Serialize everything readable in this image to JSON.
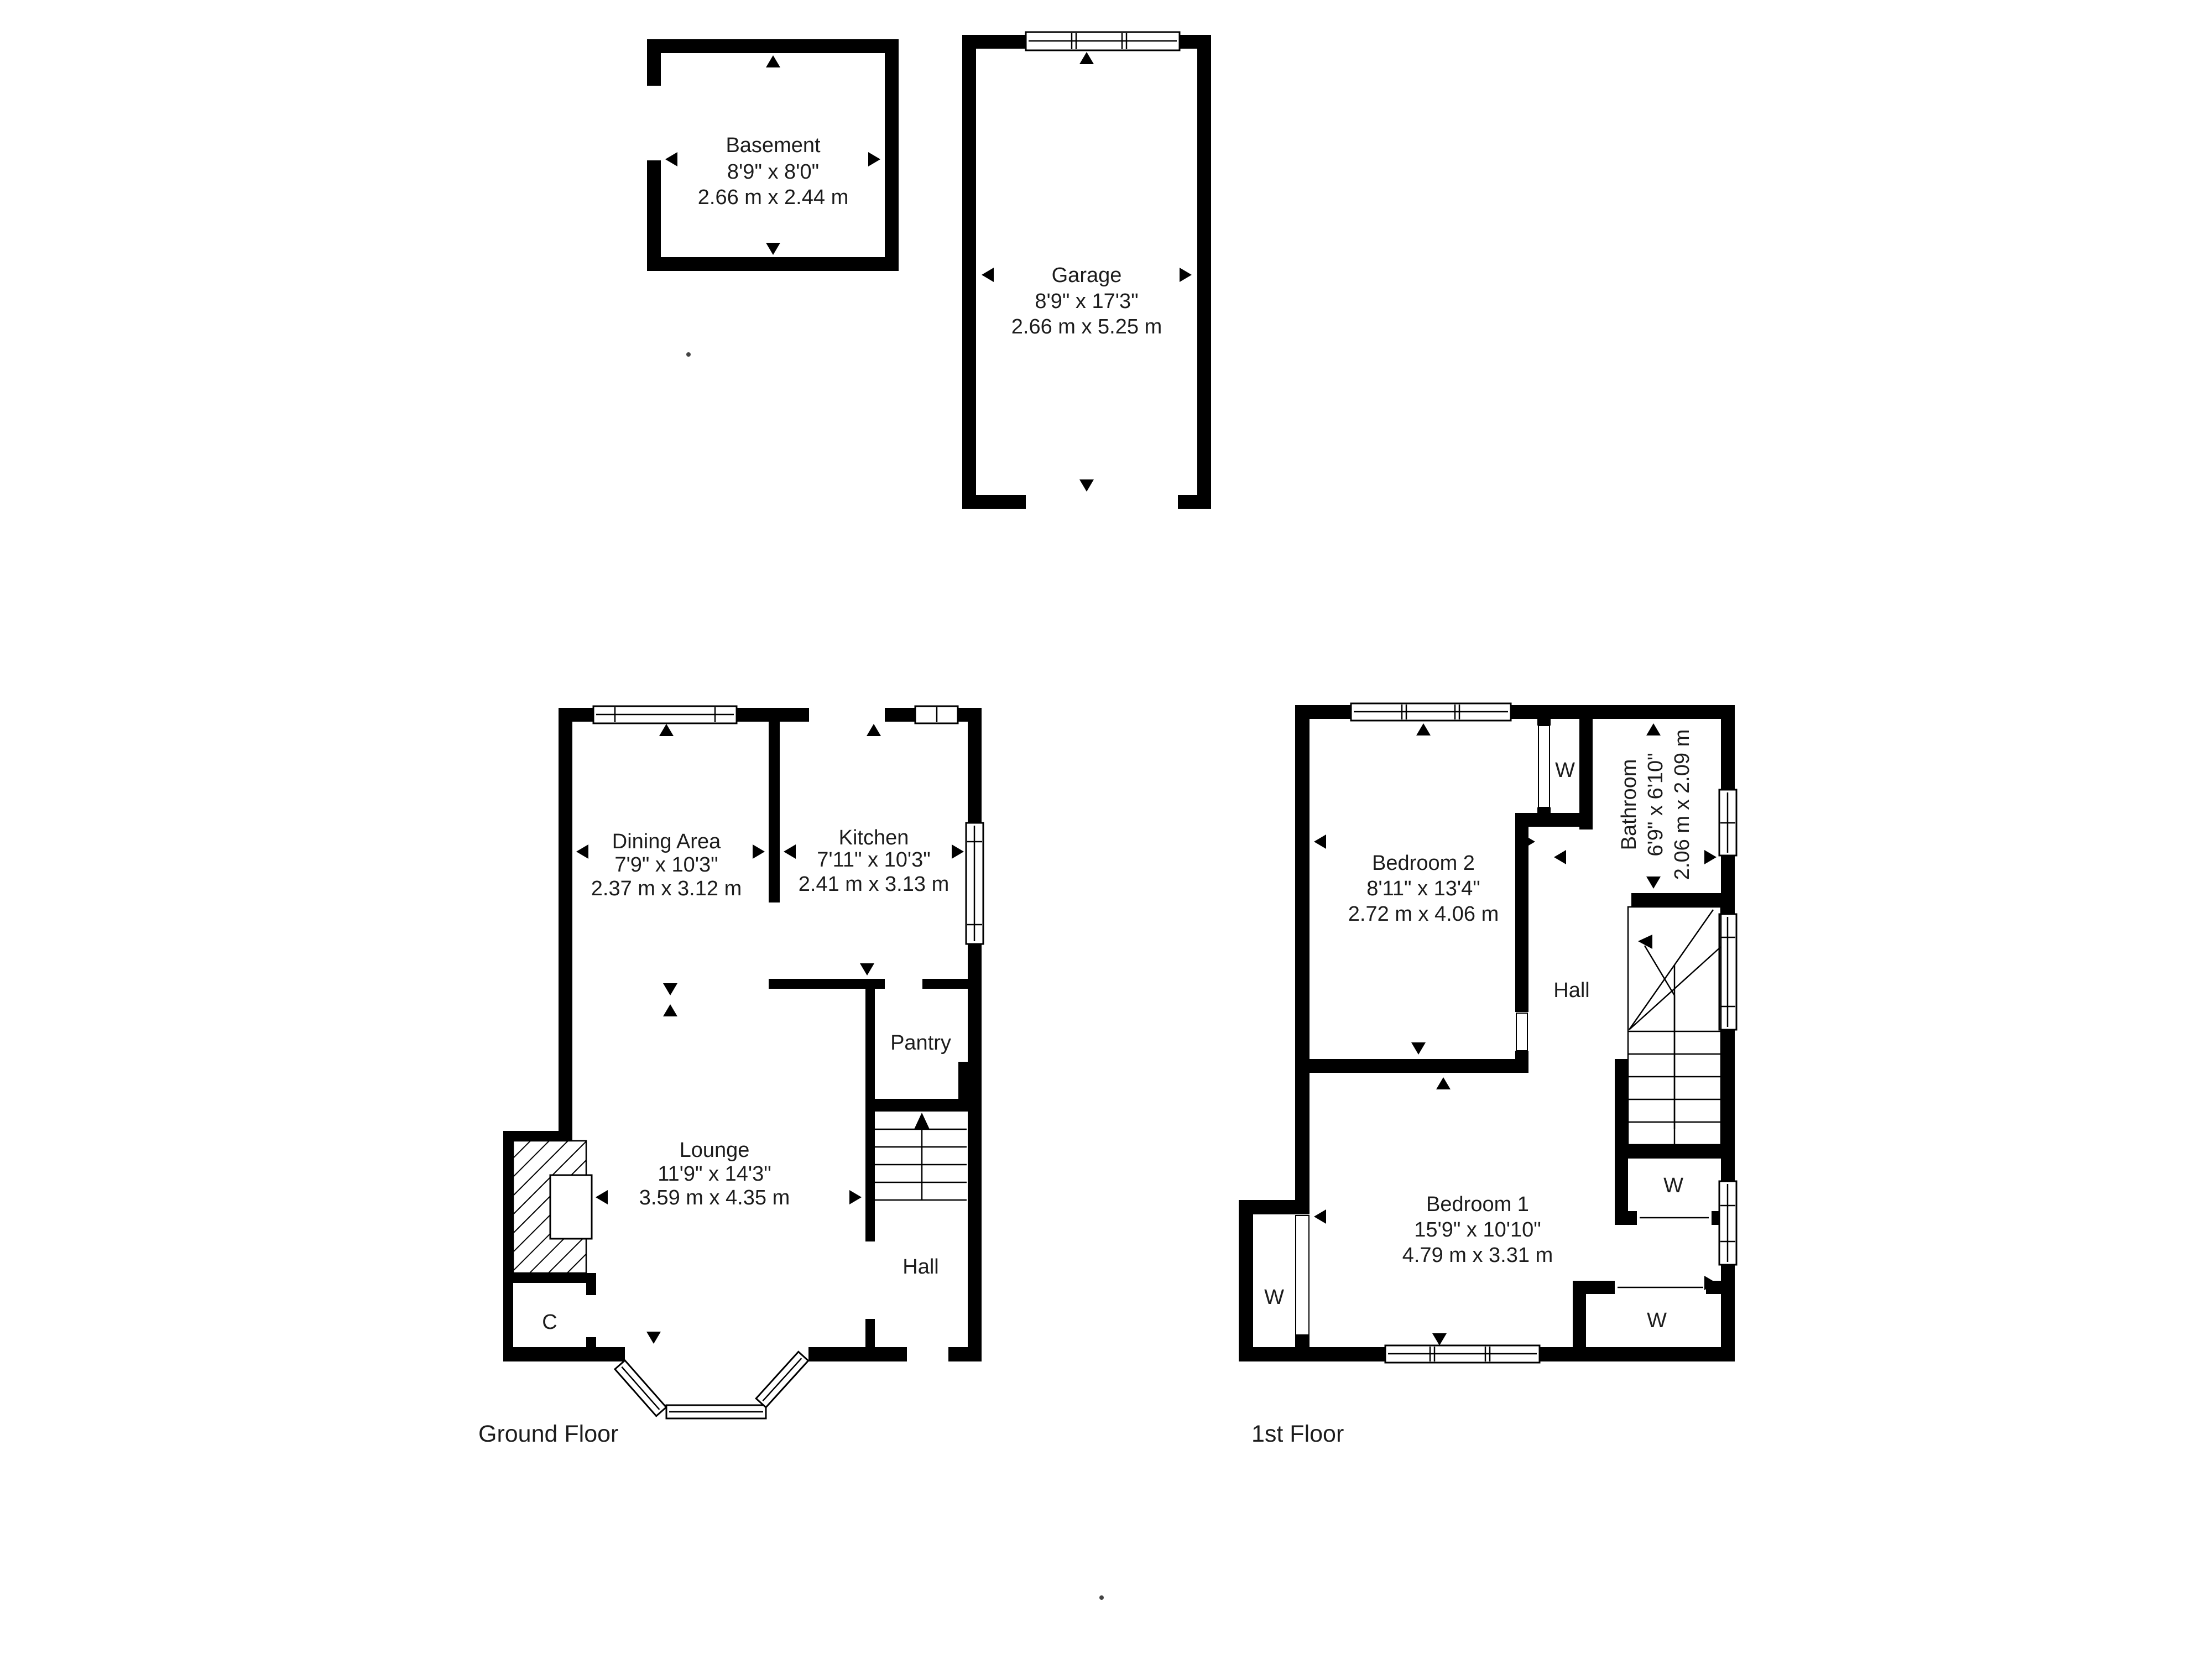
{
  "page_title": "Floor Plan",
  "wardrobe_label": "W",
  "floors": {
    "basement": {
      "name": "Basement",
      "imperial": "8'9\" x 8'0\"",
      "metric": "2.66 m x 2.44 m"
    },
    "garage": {
      "name": "Garage",
      "imperial": "8'9\" x 17'3\"",
      "metric": "2.66 m x 5.25 m"
    },
    "ground": {
      "label": "Ground Floor",
      "rooms": {
        "dining": {
          "name": "Dining Area",
          "imperial": "7'9\" x 10'3\"",
          "metric": "2.37 m x 3.12 m"
        },
        "kitchen": {
          "name": "Kitchen",
          "imperial": "7'11\" x 10'3\"",
          "metric": "2.41 m x 3.13 m"
        },
        "lounge": {
          "name": "Lounge",
          "imperial": "11'9\" x 14'3\"",
          "metric": "3.59 m x 4.35 m"
        },
        "pantry": {
          "name": "Pantry"
        },
        "hall": {
          "name": "Hall"
        },
        "cupboard": {
          "name": "C"
        }
      }
    },
    "first": {
      "label": "1st Floor",
      "rooms": {
        "bedroom2": {
          "name": "Bedroom 2",
          "imperial": "8'11\" x 13'4\"",
          "metric": "2.72 m x 4.06 m"
        },
        "bathroom": {
          "name": "Bathroom",
          "imperial": "6'9\" x 6'10\"",
          "metric": "2.06 m x 2.09 m"
        },
        "bedroom1": {
          "name": "Bedroom 1",
          "imperial": "15'9\" x 10'10\"",
          "metric": "4.79 m x 3.31 m"
        },
        "hall": {
          "name": "Hall"
        }
      }
    }
  }
}
